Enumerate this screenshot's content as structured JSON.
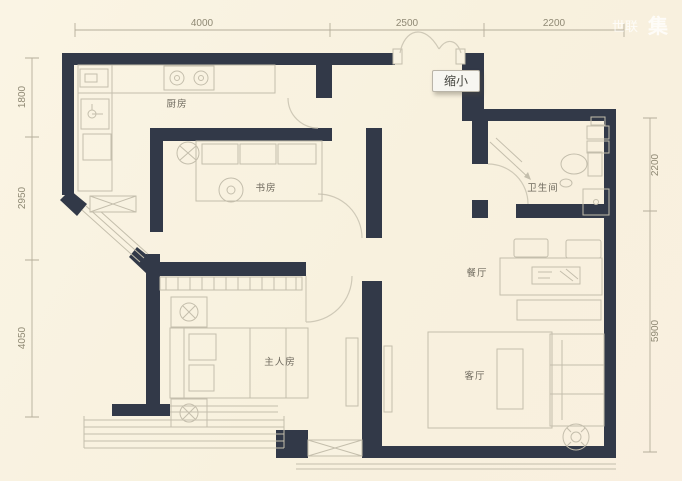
{
  "ui": {
    "zoom_out_button": "缩小"
  },
  "watermark": {
    "text1": "世联",
    "text2": "集"
  },
  "dimensions": {
    "top": [
      "4000",
      "2500",
      "2200"
    ],
    "left": [
      "1800",
      "2950",
      "4050"
    ],
    "right": [
      "2200",
      "5900"
    ]
  },
  "rooms": {
    "kitchen": "厨房",
    "study": "书房",
    "master_bedroom": "主人房",
    "bathroom": "卫生间",
    "dining_room": "餐厅",
    "living_room": "客厅"
  },
  "colors": {
    "background": "#f8f2e1",
    "wall": "#323948",
    "furniture_line": "#c4beac",
    "dimension_line": "#b5ae9b",
    "dimension_text": "#8f8974",
    "room_text": "#6f6a5e",
    "button_background": "#f7f6f1"
  }
}
